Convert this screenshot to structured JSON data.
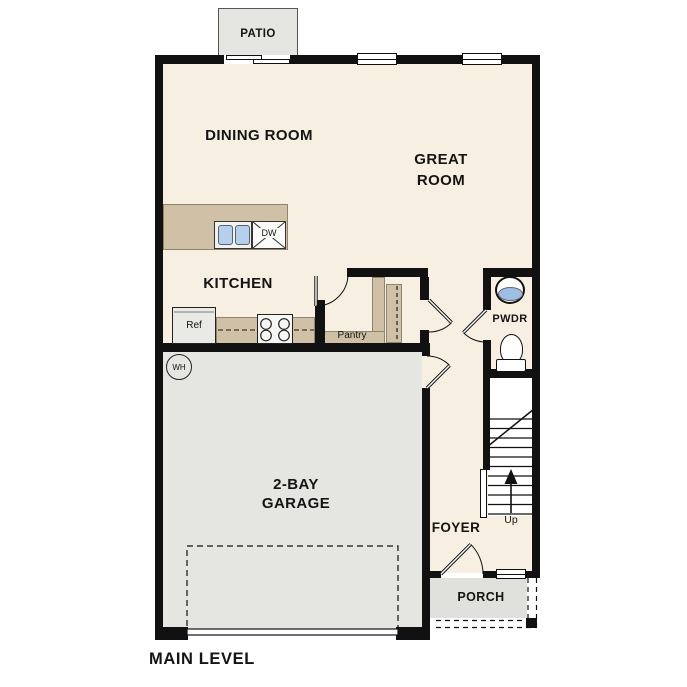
{
  "plan": {
    "title": "MAIN LEVEL",
    "rooms": {
      "patio": "PATIO",
      "dining": "DINING ROOM",
      "great_line1": "GREAT",
      "great_line2": "ROOM",
      "kitchen": "KITCHEN",
      "pwdr": "PWDR",
      "garage_line1": "2-BAY",
      "garage_line2": "GARAGE",
      "foyer": "FOYER",
      "porch": "PORCH"
    },
    "fixtures": {
      "ref": "Ref",
      "pantry": "Pantry",
      "dw": "DW",
      "wh": "WH",
      "up": "Up"
    },
    "colors": {
      "floor": "#f6efe2",
      "counter": "#cfc0a6",
      "garage_gray": "#e5e5e2",
      "wall": "#111111",
      "sink_blue": "#b6cfec"
    }
  }
}
